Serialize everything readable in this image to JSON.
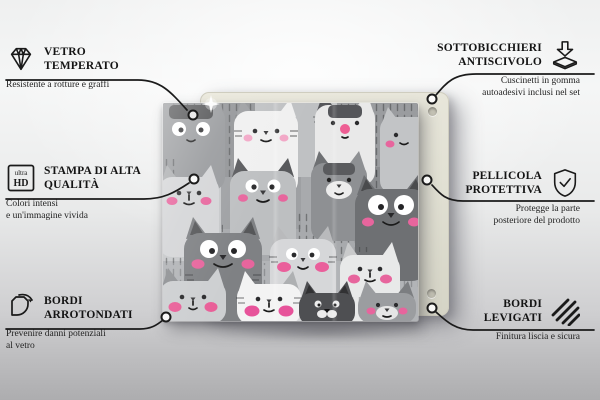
{
  "colors": {
    "accent_pink": "#e7659d",
    "line": "#1b1b1b",
    "backing_board": "#e4e2d6",
    "cat_dark_gray": "#6e7073",
    "cat_light_gray": "#d5d6d8",
    "background_top": "#f5f6f6",
    "background_bottom": "#aaaaac"
  },
  "callouts": [
    {
      "id": "vetro-temperato",
      "icon": "diamond-icon",
      "title_l1": "VETRO",
      "title_l2": "TEMPERATO",
      "sub_l1": "Resistente a rotture e graffi",
      "sub_l2": ""
    },
    {
      "id": "stampa-di-alta-qualita",
      "icon": "ultra-hd-icon",
      "icon_text_top": "ultra",
      "icon_text_bottom": "HD",
      "title_l1": "STAMPA DI ALTA",
      "title_l2": "QUALITÀ",
      "sub_l1": "Colori intensi",
      "sub_l2": "e un'immagine vivida"
    },
    {
      "id": "bordi-arrotondati",
      "icon": "rounded-corner-icon",
      "title_l1": "BORDI",
      "title_l2": "ARROTONDATI",
      "sub_l1": "Prevenire danni potenziali",
      "sub_l2": "al vetro"
    },
    {
      "id": "sottobicchieri-antiscivolo",
      "icon": "anti-slip-pad-icon",
      "title_l1": "SOTTOBICCHIERI",
      "title_l2": "ANTISCIVOLO",
      "sub_l1": "Cuscinetti in gomma",
      "sub_l2": "autoadesivi inclusi nel set"
    },
    {
      "id": "pellicola-protettiva",
      "icon": "shield-check-icon",
      "title_l1": "PELLICOLA",
      "title_l2": "PROTETTIVA",
      "sub_l1": "Protegge la parte",
      "sub_l2": "posteriore del prodotto"
    },
    {
      "id": "bordi-levigati",
      "icon": "smooth-edge-hatch-icon",
      "title_l1": "BORDI",
      "title_l2": "LEVIGATI",
      "sub_l1": "Finitura liscia e sicura",
      "sub_l2": ""
    }
  ]
}
